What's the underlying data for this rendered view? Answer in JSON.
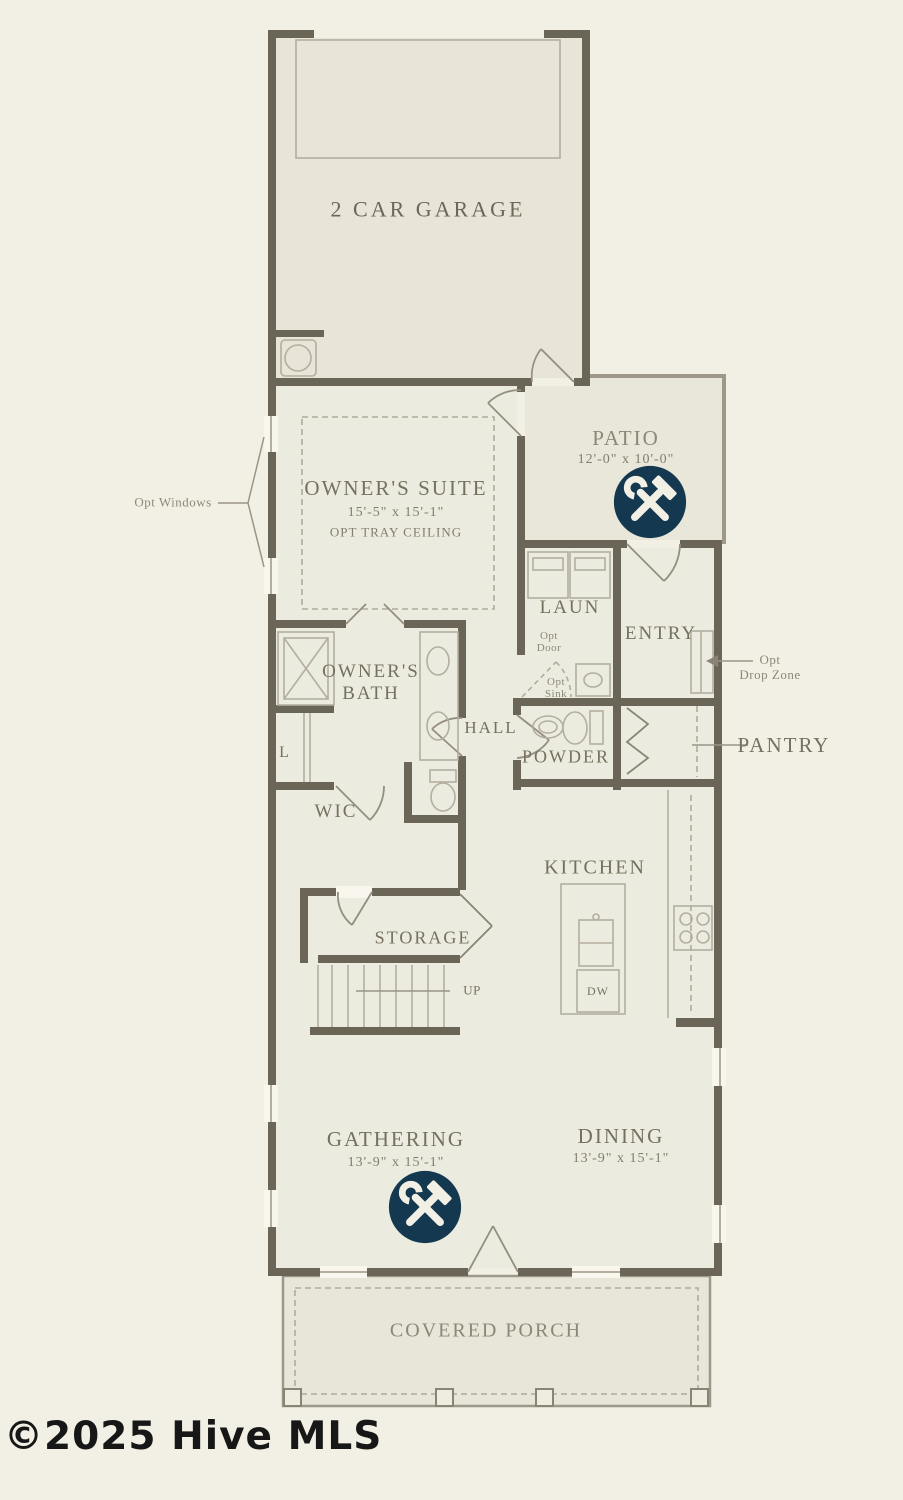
{
  "meta": {
    "watermark": "©2025 Hive MLS"
  },
  "colors": {
    "wall": "#6b6558",
    "background": "#f2f0e5",
    "interior_fill": "#ecebdf",
    "outdoor_fill": "#e9e6da",
    "accent_navy": "#133850",
    "label": "#76705e",
    "label_light": "#8d8778"
  },
  "rooms": {
    "garage": {
      "label": "2 CAR GARAGE"
    },
    "owners_suite": {
      "label": "OWNER'S SUITE",
      "dims": "15'-5\" x 15'-1\"",
      "note": "OPT TRAY CEILING"
    },
    "patio": {
      "label": "PATIO",
      "dims": "12'-0\" x 10'-0\""
    },
    "laundry": {
      "label": "LAUN"
    },
    "entry": {
      "label": "ENTRY"
    },
    "owners_bath": {
      "label": "OWNER'S BATH"
    },
    "hall": {
      "label": "HALL"
    },
    "powder": {
      "label": "POWDER"
    },
    "pantry": {
      "label": "PANTRY"
    },
    "wic": {
      "label": "WIC"
    },
    "storage": {
      "label": "STORAGE"
    },
    "kitchen": {
      "label": "KITCHEN"
    },
    "gathering": {
      "label": "GATHERING",
      "dims": "13'-9\" x 15'-1\""
    },
    "dining": {
      "label": "DINING",
      "dims": "13'-9\" x 15'-1\""
    },
    "covered_porch": {
      "label": "COVERED PORCH"
    }
  },
  "annotations": {
    "opt_windows": "Opt Windows",
    "opt_drop_zone_line1": "Opt",
    "opt_drop_zone_line2": "Drop Zone",
    "opt_door_line1": "Opt",
    "opt_door_line2": "Door",
    "opt_sink_line1": "Opt",
    "opt_sink_line2": "Sink",
    "up": "UP",
    "dw": "DW",
    "linen": "L"
  },
  "icons": {
    "customization": "hammer-wrench"
  }
}
